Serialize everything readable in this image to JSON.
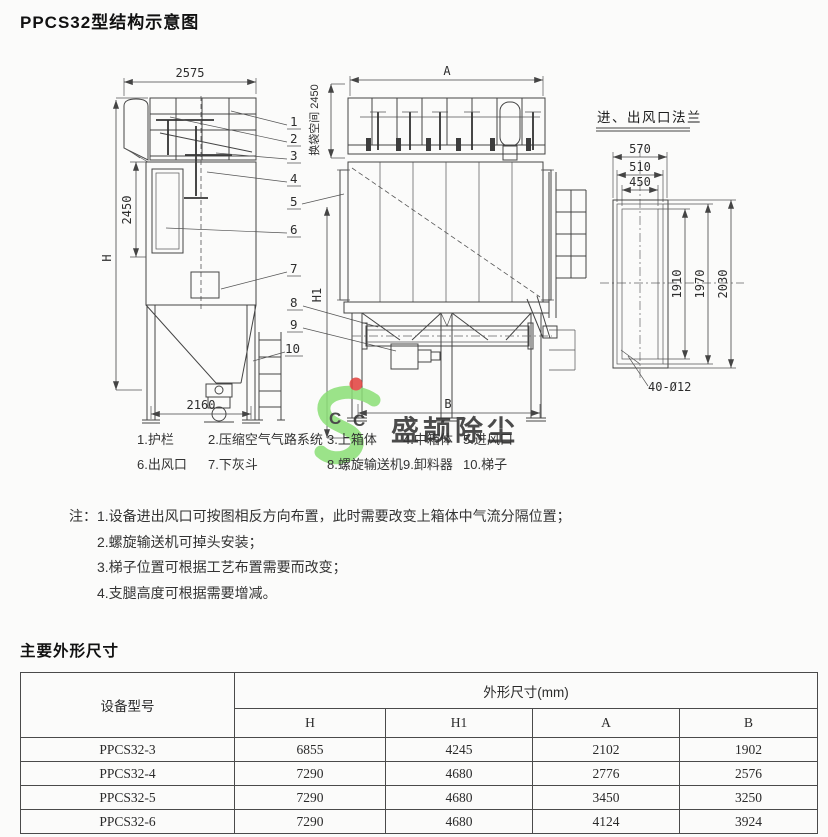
{
  "page": {
    "title": "PPCS32型结构示意图"
  },
  "diagram": {
    "side_view": {
      "top_width": "2575",
      "body_height": "2450",
      "total_height": "H",
      "base_width": "2160"
    },
    "front_view": {
      "top_width": "A",
      "base_width": "B",
      "leg_height": "H1",
      "bag_space": "换袋空间 2450"
    },
    "part_numbers": [
      "1",
      "2",
      "3",
      "4",
      "5",
      "6",
      "7",
      "8",
      "9",
      "10"
    ],
    "flange_detail": {
      "title": "进、出风口法兰",
      "width_dims": [
        "570",
        "510",
        "450"
      ],
      "height_dims": [
        "1910",
        "1970",
        "2030"
      ],
      "bolt_holes": "40-Ø12"
    },
    "legend": {
      "row1": [
        "1.护栏",
        "2.压缩空气气路系统",
        "3.上箱体",
        "4.中箱体",
        "5.进风口"
      ],
      "row2": [
        "6.出风口",
        "7.下灰斗",
        "8.螺旋输送机",
        "9.卸料器",
        "10.梯子"
      ]
    }
  },
  "watermark": {
    "brand": "盛颉除尘",
    "letters": [
      "C",
      "C"
    ],
    "colors": {
      "green": "#8bdf76",
      "blue": "#8fb3e6",
      "red": "#e2403c",
      "yellow": "#edda3f"
    }
  },
  "notes": {
    "label": "注：",
    "items": [
      "1.设备进出风口可按图相反方向布置，此时需要改变上箱体中气流分隔位置；",
      "2.螺旋输送机可掉头安装；",
      "3.梯子位置可根据工艺布置需要而改变；",
      "4.支腿高度可根据需要增减。"
    ]
  },
  "table_section": {
    "title": "主要外形尺寸",
    "table": {
      "col1_header": "设备型号",
      "group_header": "外形尺寸(mm)",
      "sub_headers": [
        "H",
        "H1",
        "A",
        "B"
      ],
      "rows": [
        {
          "model": "PPCS32-3",
          "values": [
            "6855",
            "4245",
            "2102",
            "1902"
          ]
        },
        {
          "model": "PPCS32-4",
          "values": [
            "7290",
            "4680",
            "2776",
            "2576"
          ]
        },
        {
          "model": "PPCS32-5",
          "values": [
            "7290",
            "4680",
            "3450",
            "3250"
          ]
        },
        {
          "model": "PPCS32-6",
          "values": [
            "7290",
            "4680",
            "4124",
            "3924"
          ]
        }
      ]
    }
  }
}
